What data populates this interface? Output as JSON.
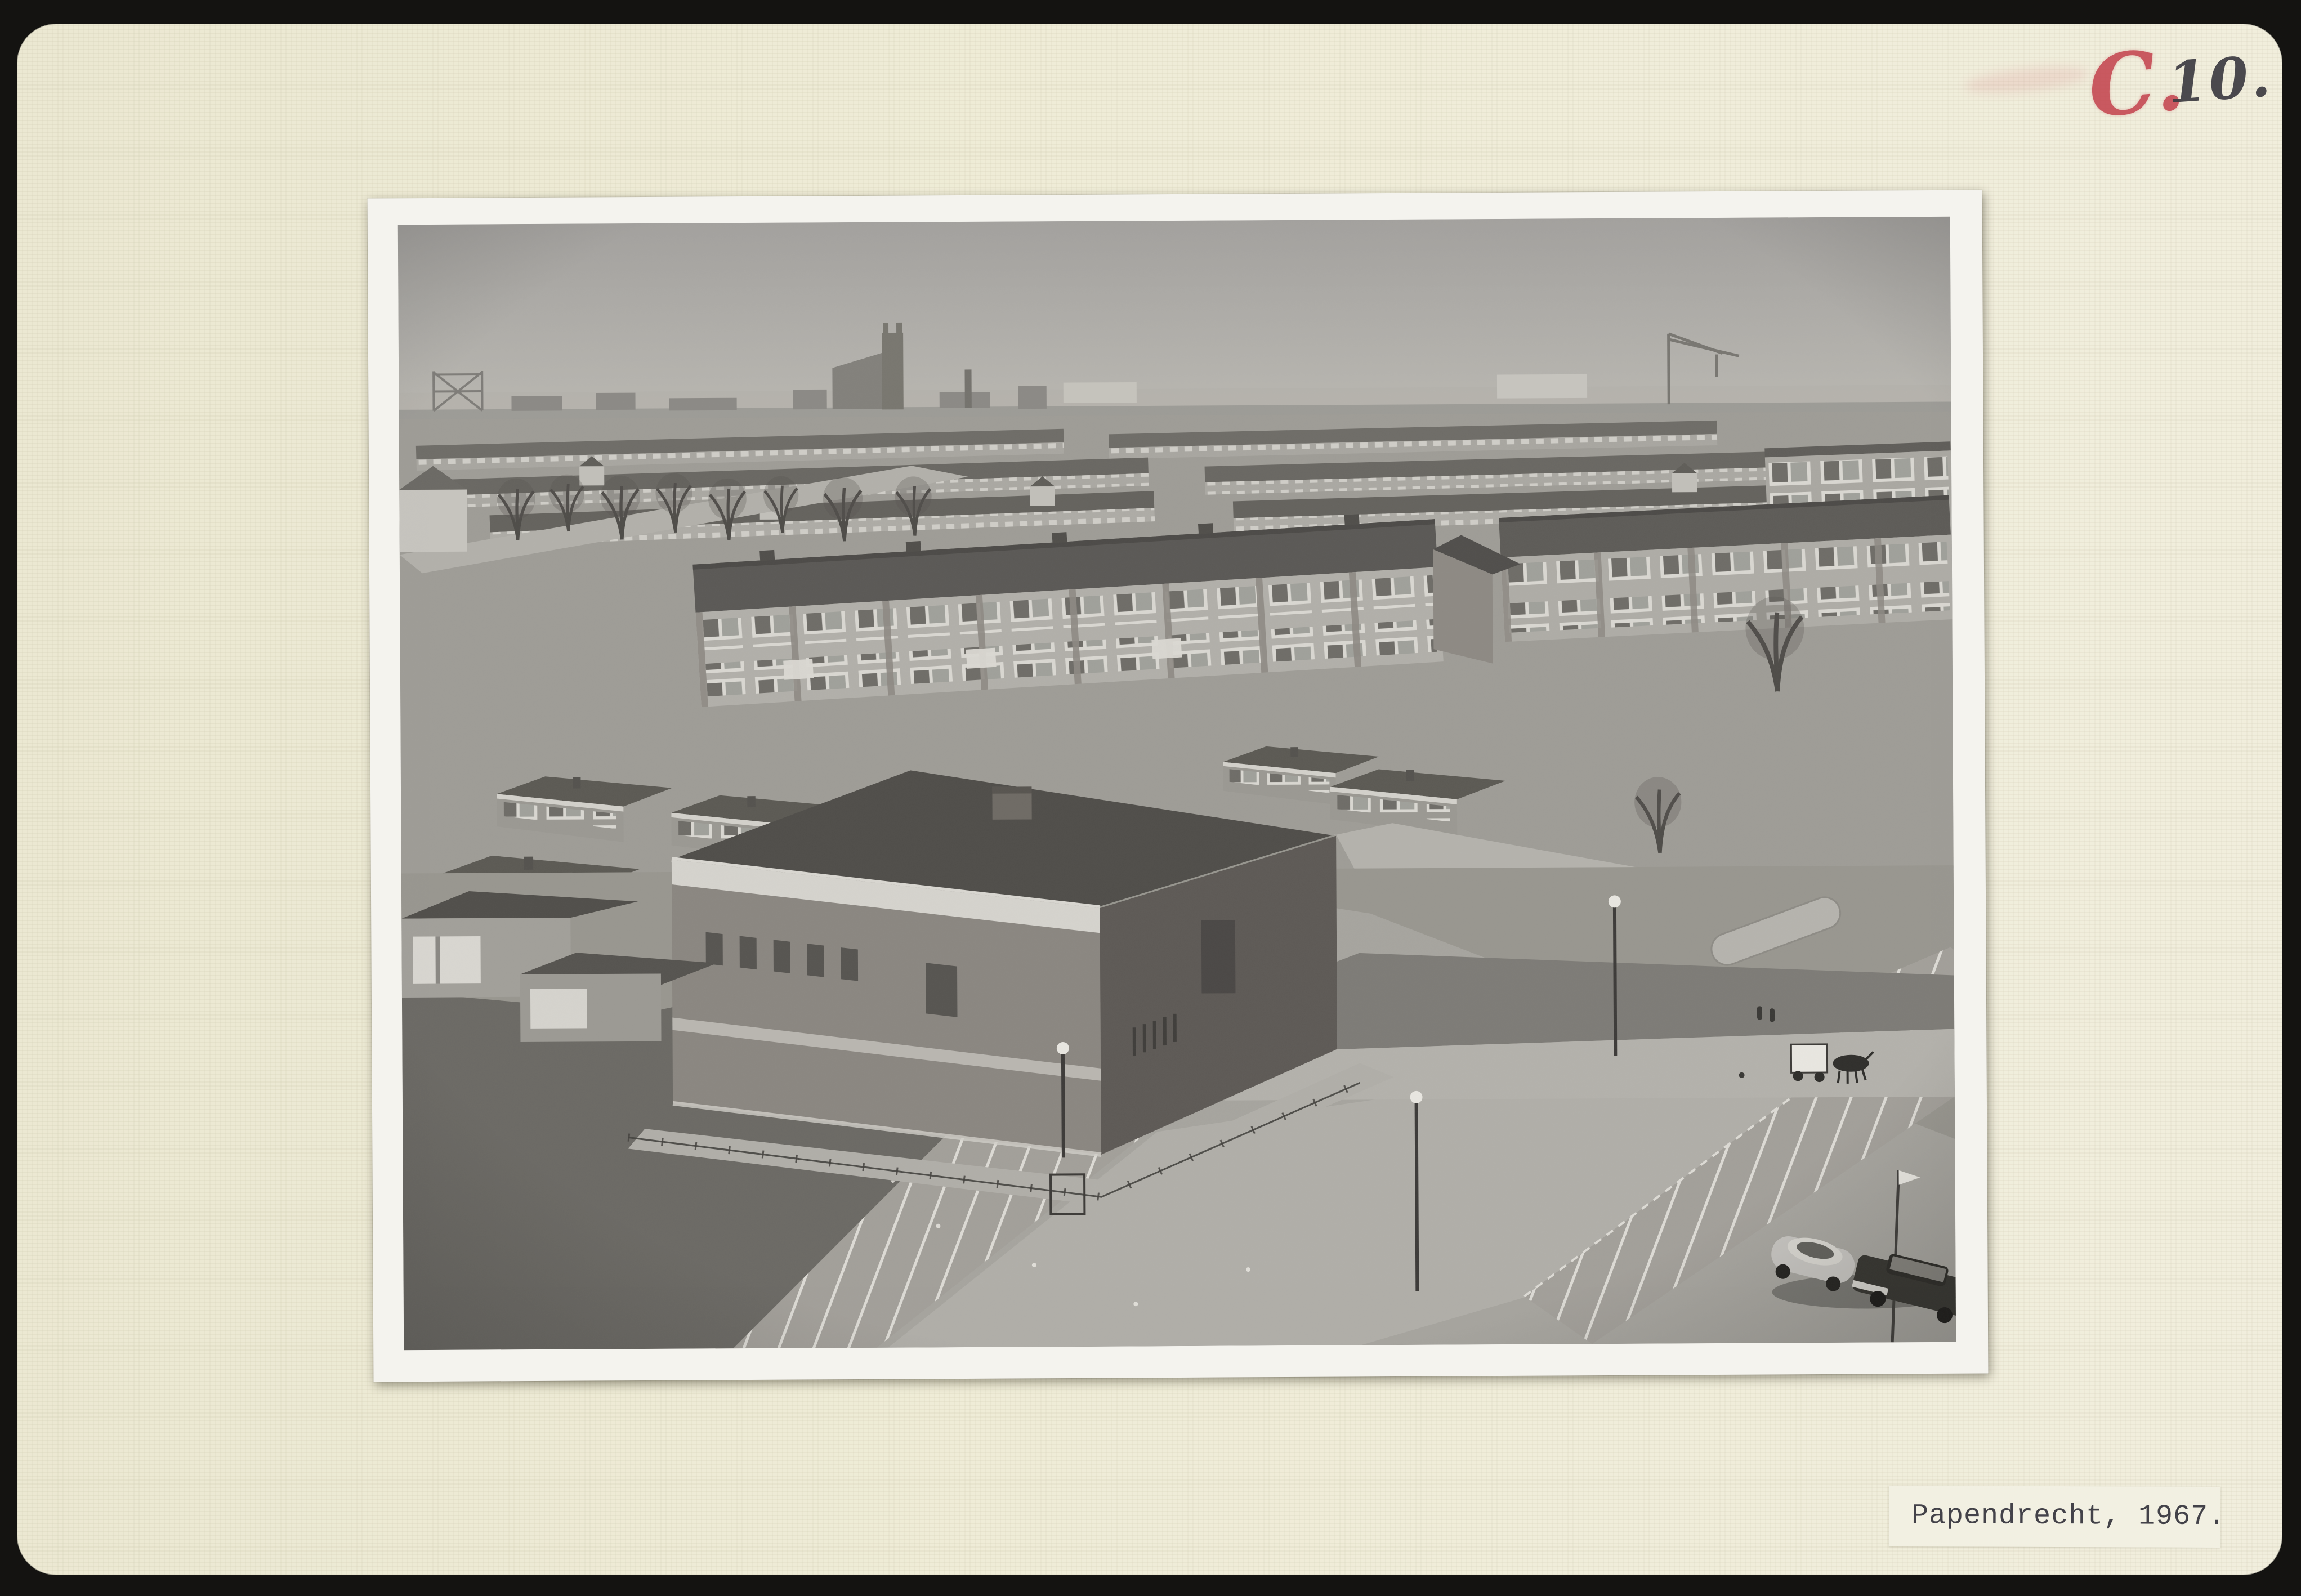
{
  "palette": {
    "scan_bg": "#141311",
    "card": "#efecd7",
    "card_edge": "#e6e3cd",
    "red_ink": "#c4454f",
    "pencil_ink": "#3d3c42",
    "photo_border": "#f4f3ee",
    "tape": "#f3f1e3",
    "caption_ink": "#3e3d45"
  },
  "annotation": {
    "red_letter": "C.",
    "black_number": "10."
  },
  "caption": {
    "text": "Papendrecht, 1967."
  },
  "photo": {
    "kind": "black-and-white aerial photograph with white print border",
    "scene_elements": [
      "sky",
      "town-skyline",
      "church-tower",
      "construction-crane",
      "chimney",
      "terraced-housing-rows",
      "apartment-flats",
      "flat-roofed-bungalows",
      "bare-trees",
      "brick-utility-building",
      "chain-link-fence",
      "street",
      "street-lamps",
      "parking-lot",
      "parking-bay-markings",
      "curb-islands",
      "grass-field",
      "volkswagen-beetle",
      "dark-sedan",
      "horse-drawn-cart",
      "pedestrians",
      "flag-pole"
    ],
    "tones": {
      "sky": "#b0aeaa",
      "roofs": "#5c5a56",
      "facades": "#b1afa9",
      "pavement": "#a6a49e",
      "grass": "#6b6964"
    }
  }
}
